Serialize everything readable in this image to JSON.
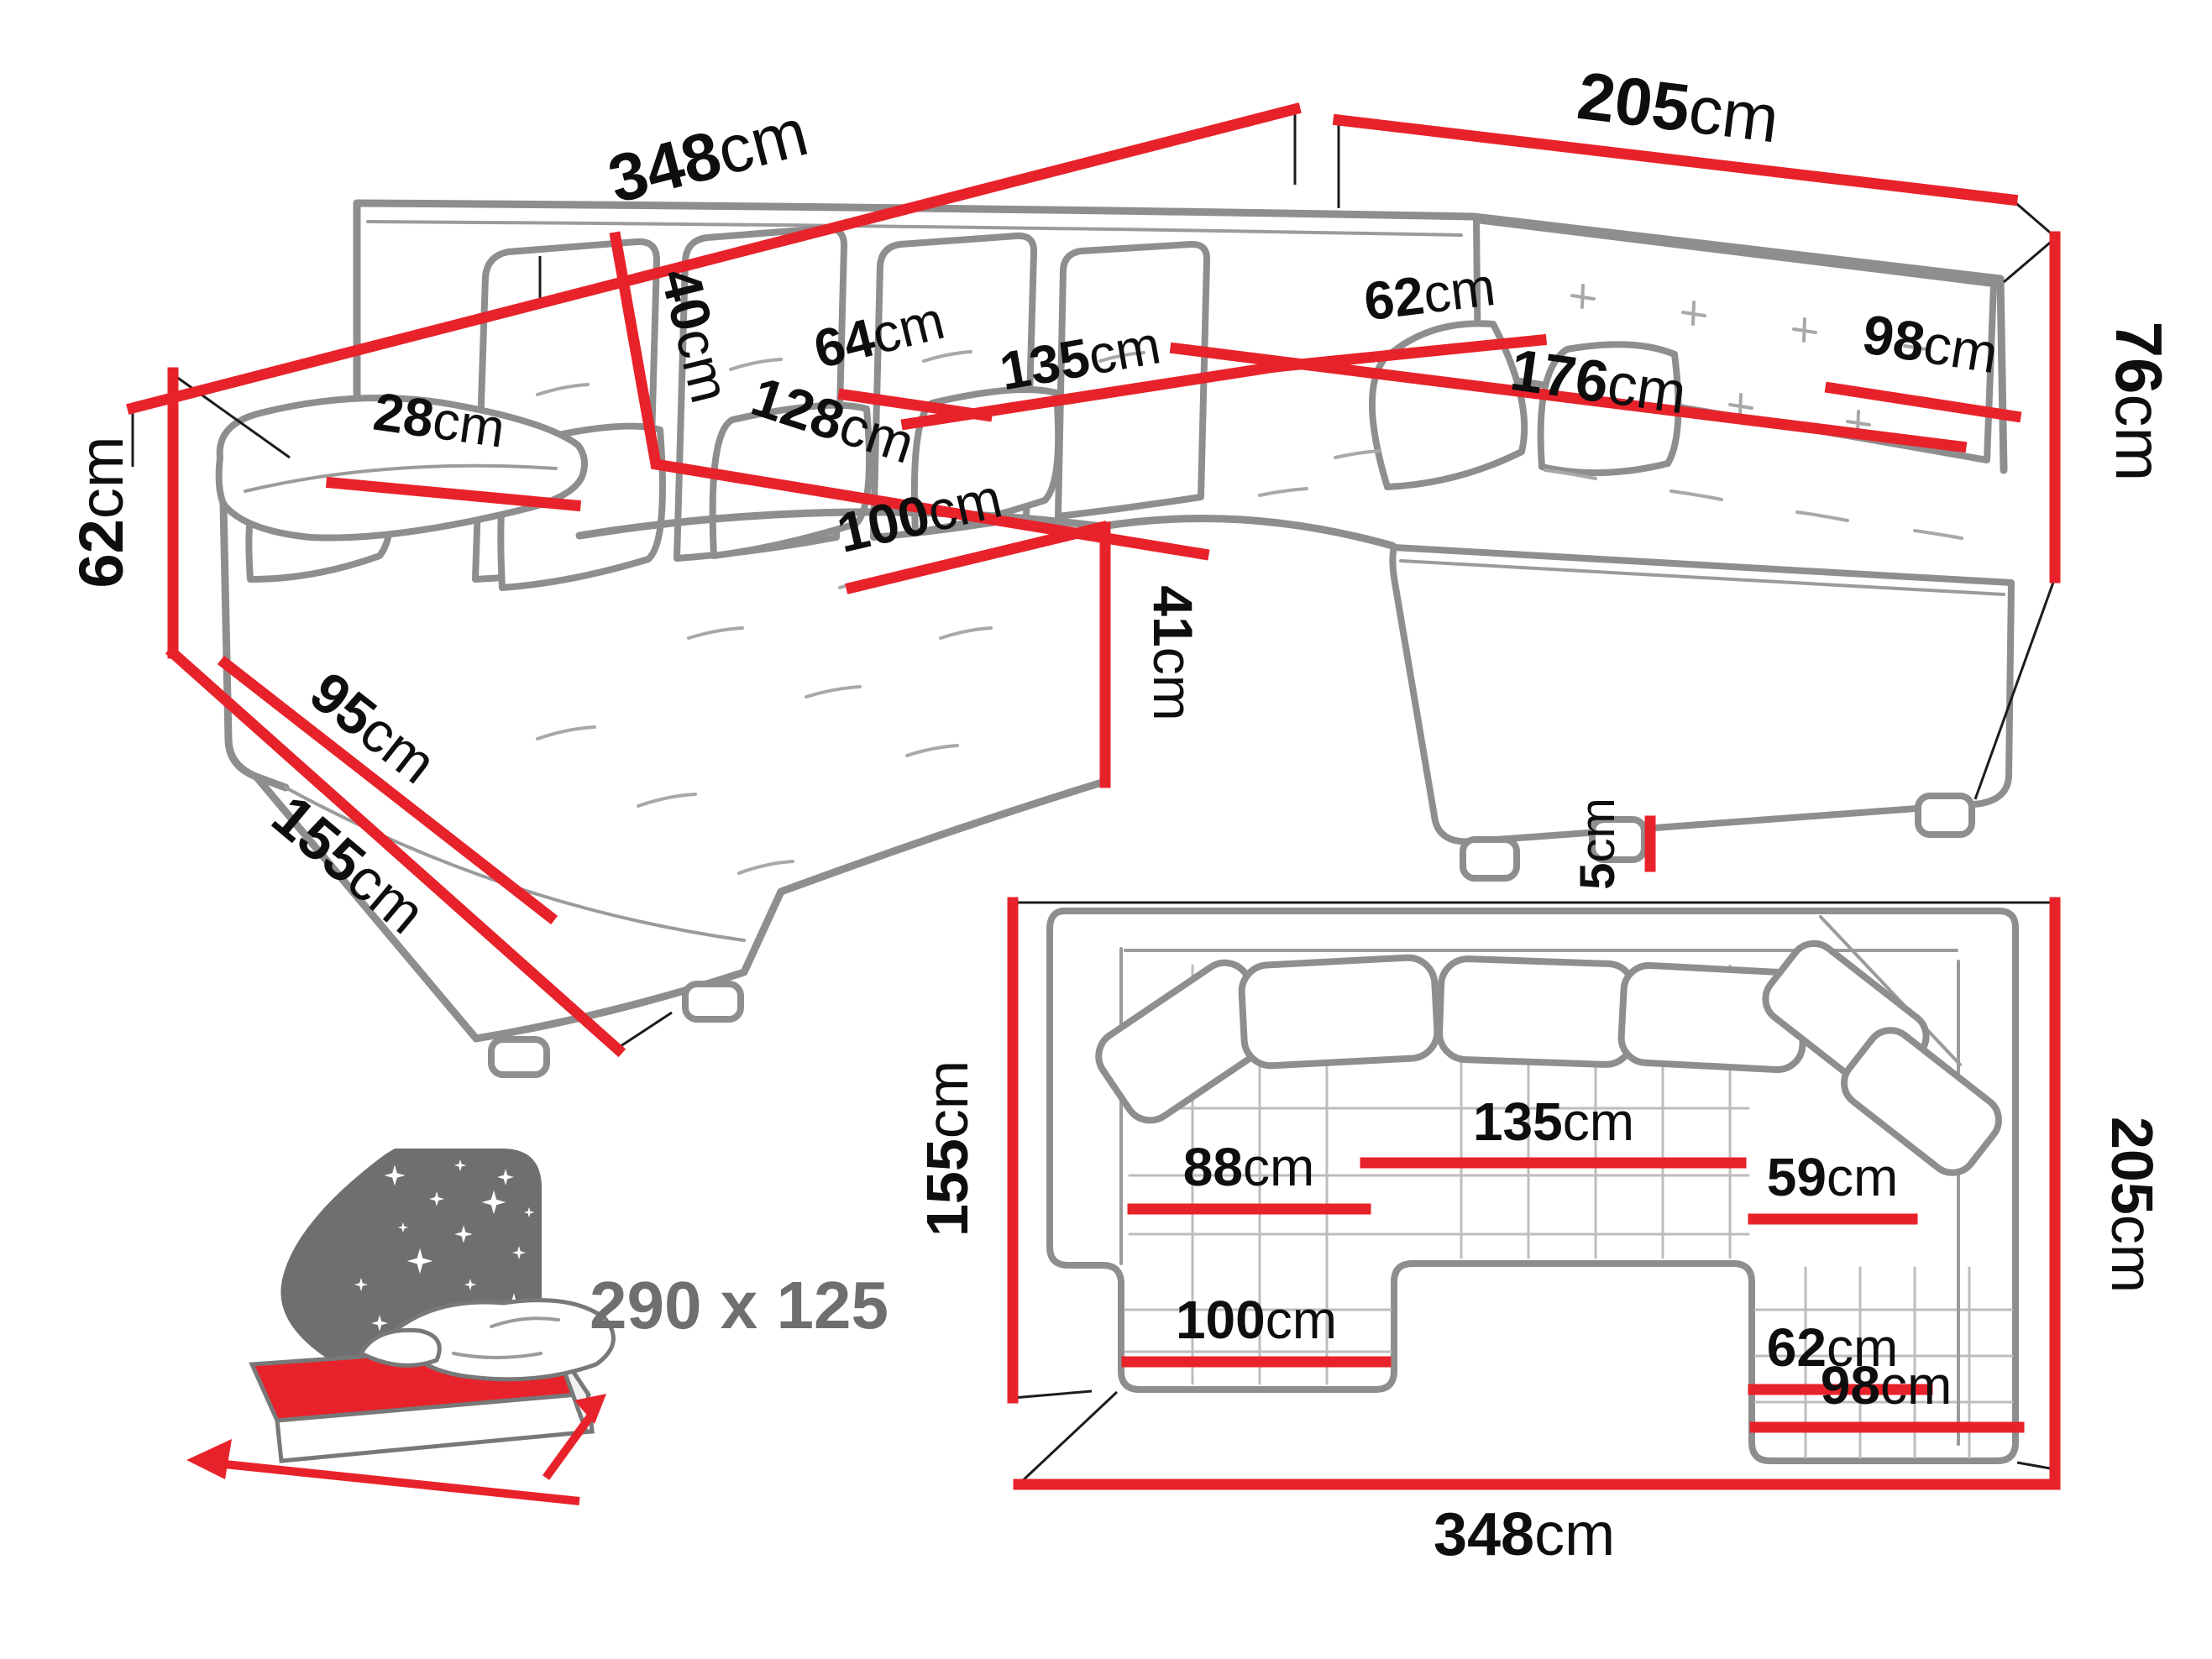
{
  "document": {
    "type": "corner-sofa dimension diagram",
    "unit": "cm"
  },
  "colors": {
    "dimension_line": "#e8222a",
    "sofa_outline": "#8e8e8e",
    "label_text": "#0e0e0e",
    "bed_icon_gray": "#6f6f6f"
  },
  "perspective_view": {
    "labels": {
      "total_back_width": {
        "value": "348",
        "unit": "cm"
      },
      "right_back_width": {
        "value": "205",
        "unit": "cm"
      },
      "backrest_height": {
        "value": "76",
        "unit": "cm"
      },
      "left_side_height": {
        "value": "62",
        "unit": "cm"
      },
      "chaise_side_length": {
        "value": "155",
        "unit": "cm"
      },
      "left_base_length": {
        "value": "95",
        "unit": "cm"
      },
      "armrest_width": {
        "value": "28",
        "unit": "cm"
      },
      "back_cushion_height": {
        "value": "40",
        "unit": "cm"
      },
      "seat_depth": {
        "value": "64",
        "unit": "cm"
      },
      "middle_seat_width": {
        "value": "135",
        "unit": "cm"
      },
      "seat_diagonal": {
        "value": "128",
        "unit": "cm"
      },
      "corner_seat_depth": {
        "value": "62",
        "unit": "cm"
      },
      "right_seat_length": {
        "value": "176",
        "unit": "cm"
      },
      "right_seat_depth": {
        "value": "98",
        "unit": "cm"
      },
      "chaise_width": {
        "value": "100",
        "unit": "cm"
      },
      "seat_height": {
        "value": "41",
        "unit": "cm"
      },
      "leg_height": {
        "value": "5",
        "unit": "cm"
      }
    }
  },
  "plan_view": {
    "labels": {
      "left_depth": {
        "value": "155",
        "unit": "cm"
      },
      "right_depth": {
        "value": "205",
        "unit": "cm"
      },
      "total_width": {
        "value": "348",
        "unit": "cm"
      },
      "chaise_inner_width": {
        "value": "88",
        "unit": "cm"
      },
      "middle_width": {
        "value": "135",
        "unit": "cm"
      },
      "corner_inner_width": {
        "value": "59",
        "unit": "cm"
      },
      "right_inner_width": {
        "value": "62",
        "unit": "cm"
      },
      "chaise_width": {
        "value": "100",
        "unit": "cm"
      },
      "right_arm_width": {
        "value": "98",
        "unit": "cm"
      }
    }
  },
  "bed_icon": {
    "sleeping_area_label": "290 x 125"
  }
}
